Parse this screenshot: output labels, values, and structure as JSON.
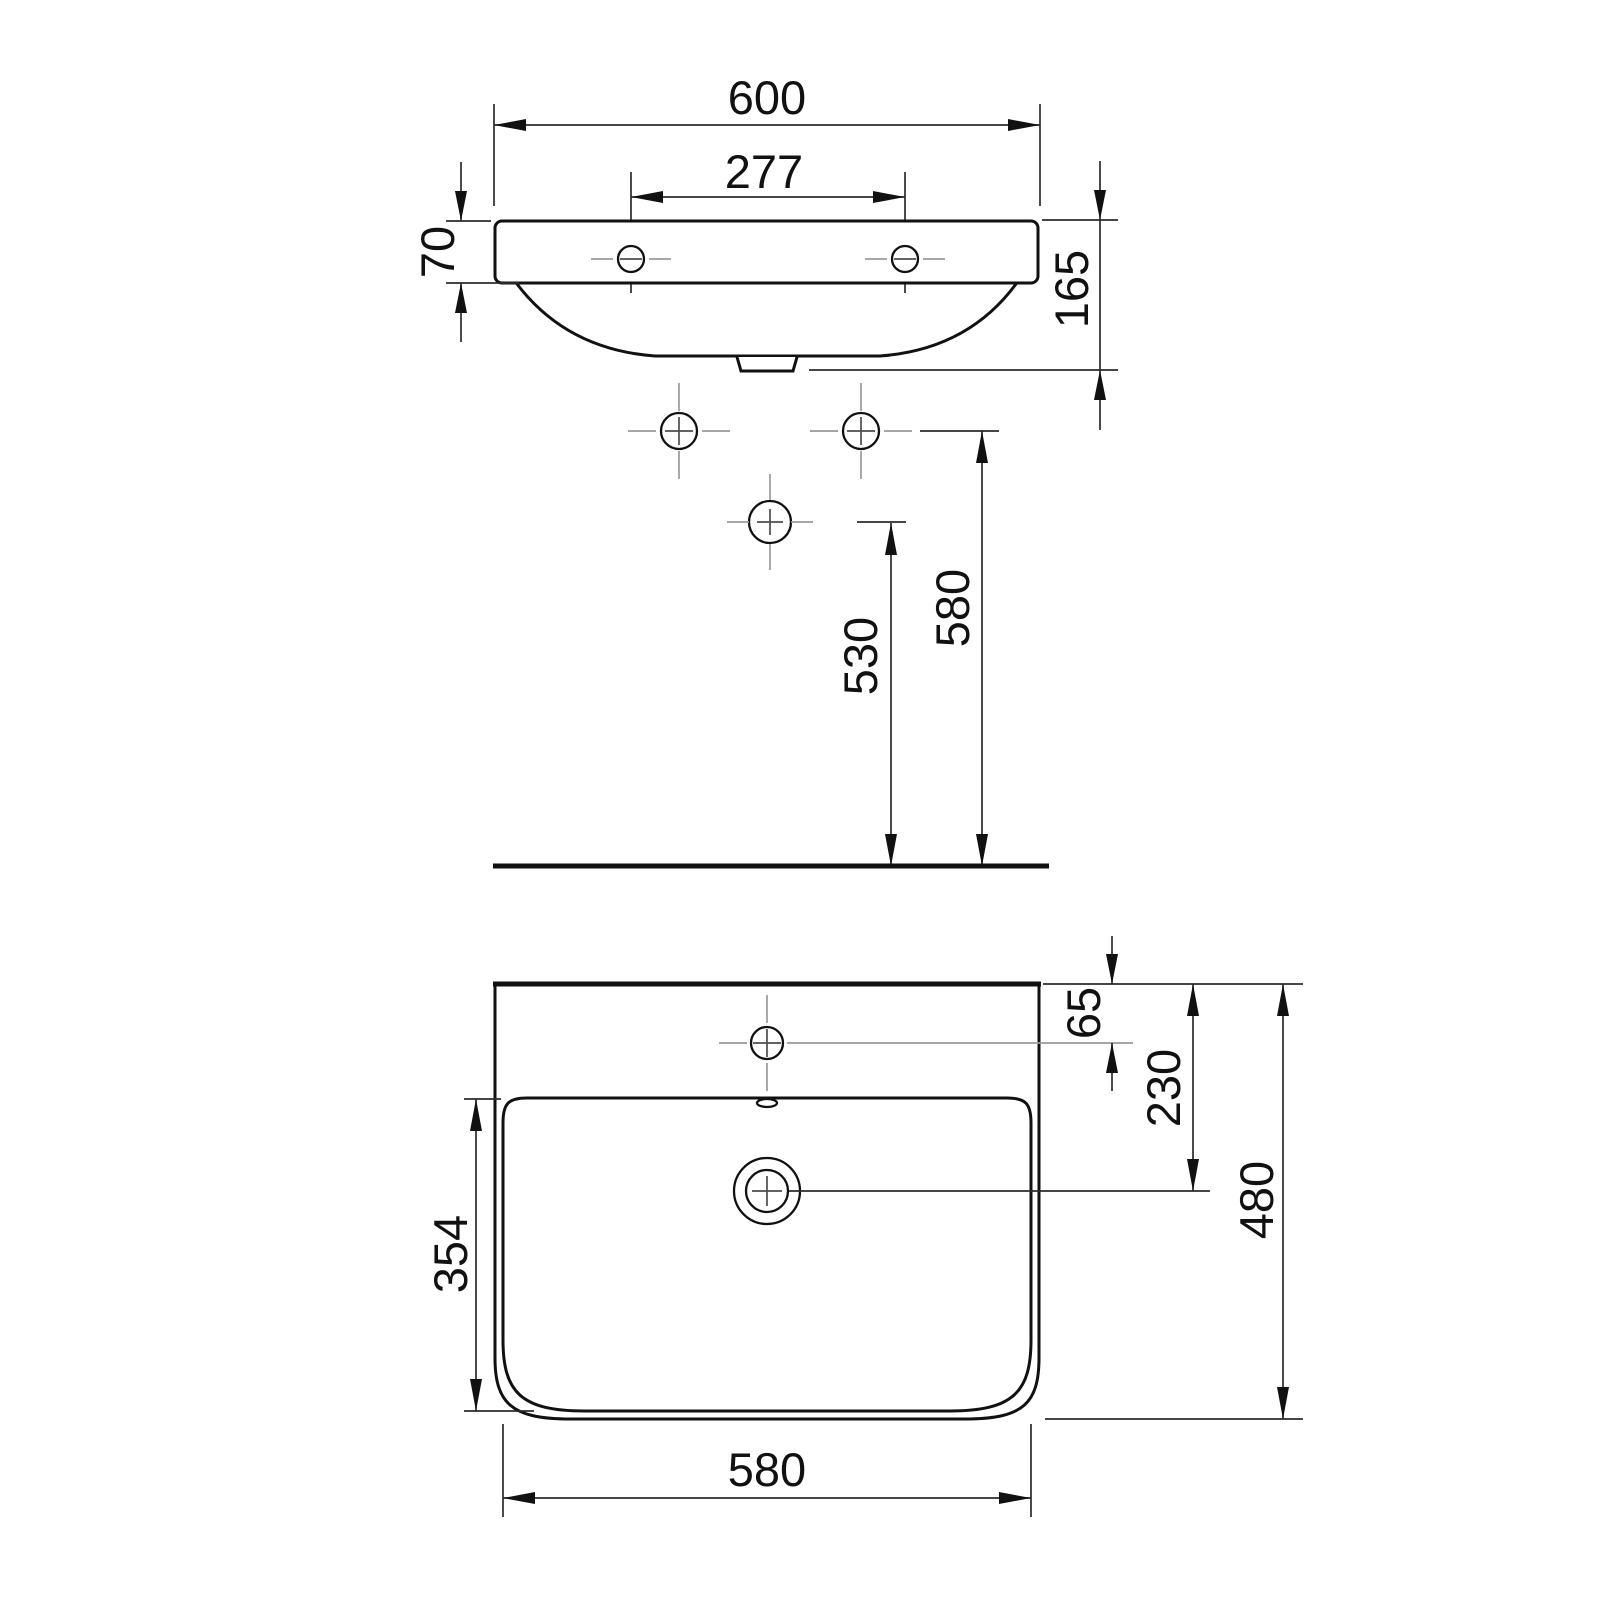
{
  "drawing": {
    "type": "technical-dimension-drawing",
    "subject": "wall-hung washbasin, front elevation and plan view",
    "units": "mm",
    "colors": {
      "background": "#ffffff",
      "outline": "#111111",
      "dimension_line": "#2b2b2b",
      "centerline": "#9a9a9a"
    },
    "front_view": {
      "overall_width": "600",
      "tap_hole_spacing": "277",
      "rim_height": "70",
      "overall_height": "165",
      "trap_outlet_height": "530",
      "fixing_hole_height": "580"
    },
    "plan_view": {
      "tap_hole_offset": "65",
      "drain_offset": "230",
      "overall_depth": "480",
      "basin_inner_depth": "354",
      "basin_width": "580"
    }
  }
}
